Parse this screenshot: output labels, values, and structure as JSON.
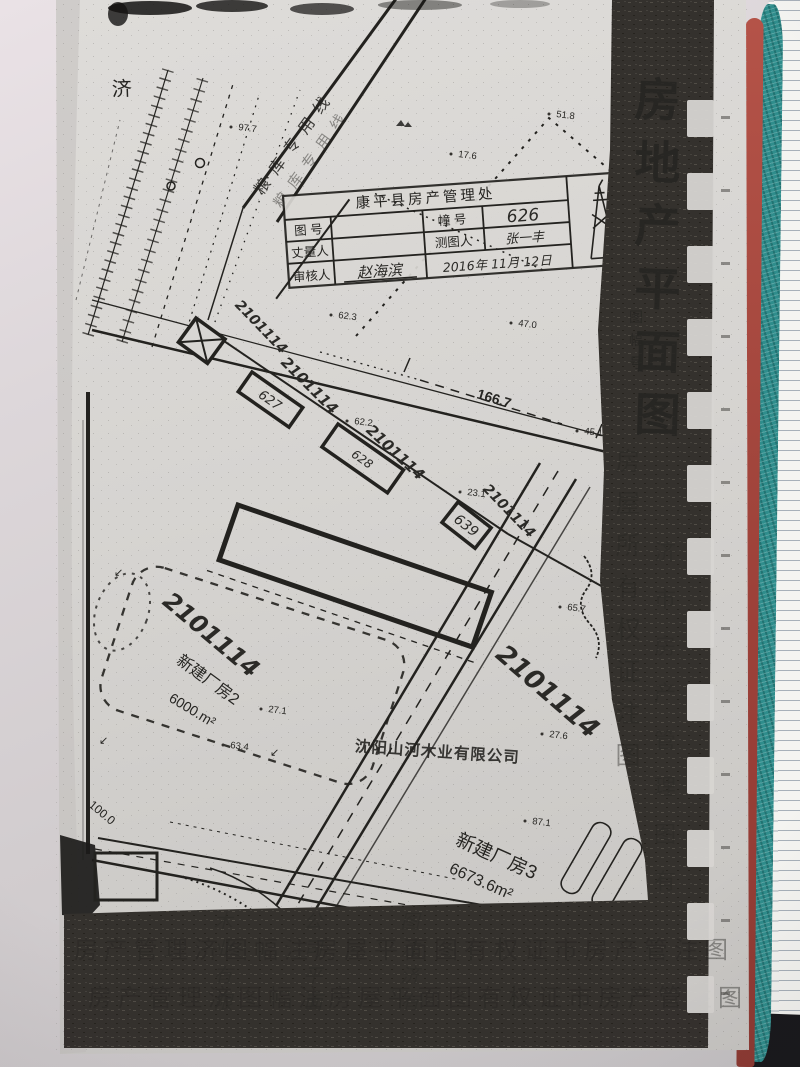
{
  "document": {
    "side_title": "房地产平面图",
    "side_subtitle": "图幅号",
    "stamp": {
      "office": "康平县房产管理处",
      "field_map_no": "图 号",
      "field_building_no": "幢 号",
      "building_no": "626",
      "field_surveyor": "丈量人",
      "field_drafter": "测图人",
      "drafter": "张一丰",
      "field_checker": "审核人",
      "checker": "赵海滨",
      "date": "2016年 11月 12日"
    },
    "map": {
      "place_char": "济",
      "road_label": "粮库专用线",
      "parcel_no": "2101114",
      "building_627": "627",
      "building_628": "628",
      "building_639": "639",
      "dim_road": "166.7",
      "dim_left": "100.0",
      "company": "沈阳山河木业有限公司",
      "factory2_name": "新建厂房2",
      "factory2_area": "6000.m²",
      "factory3_name": "新建厂房3",
      "factory3_area": "6673.6m²",
      "elevations": [
        "97.7",
        "17.6",
        "51.8",
        "62.3",
        "47.0",
        "62.2",
        "23.1",
        "45.1",
        "65.7",
        "27.1",
        "63.4",
        "27.6",
        "87.1"
      ],
      "slope_arrow": "↙"
    },
    "ghost": {
      "band_bottom": "房产管理济图幅注房屋平面图有权证市房产管注图",
      "band_right_col1": "房屋所有权证注图",
      "band_right_col2": "济市房产管理图有",
      "bleed_col1": "木业有限",
      "bleed_col2": "公司平面",
      "bleed_col3": "图注济有"
    },
    "colors": {
      "paper": "#d7d5d2",
      "photocopy_band": "#34312d",
      "notebook_red_edge": "#a64840",
      "notebook_teal_edge": "#2f8d8c",
      "ruled_paper": "#f4f4f1"
    }
  }
}
